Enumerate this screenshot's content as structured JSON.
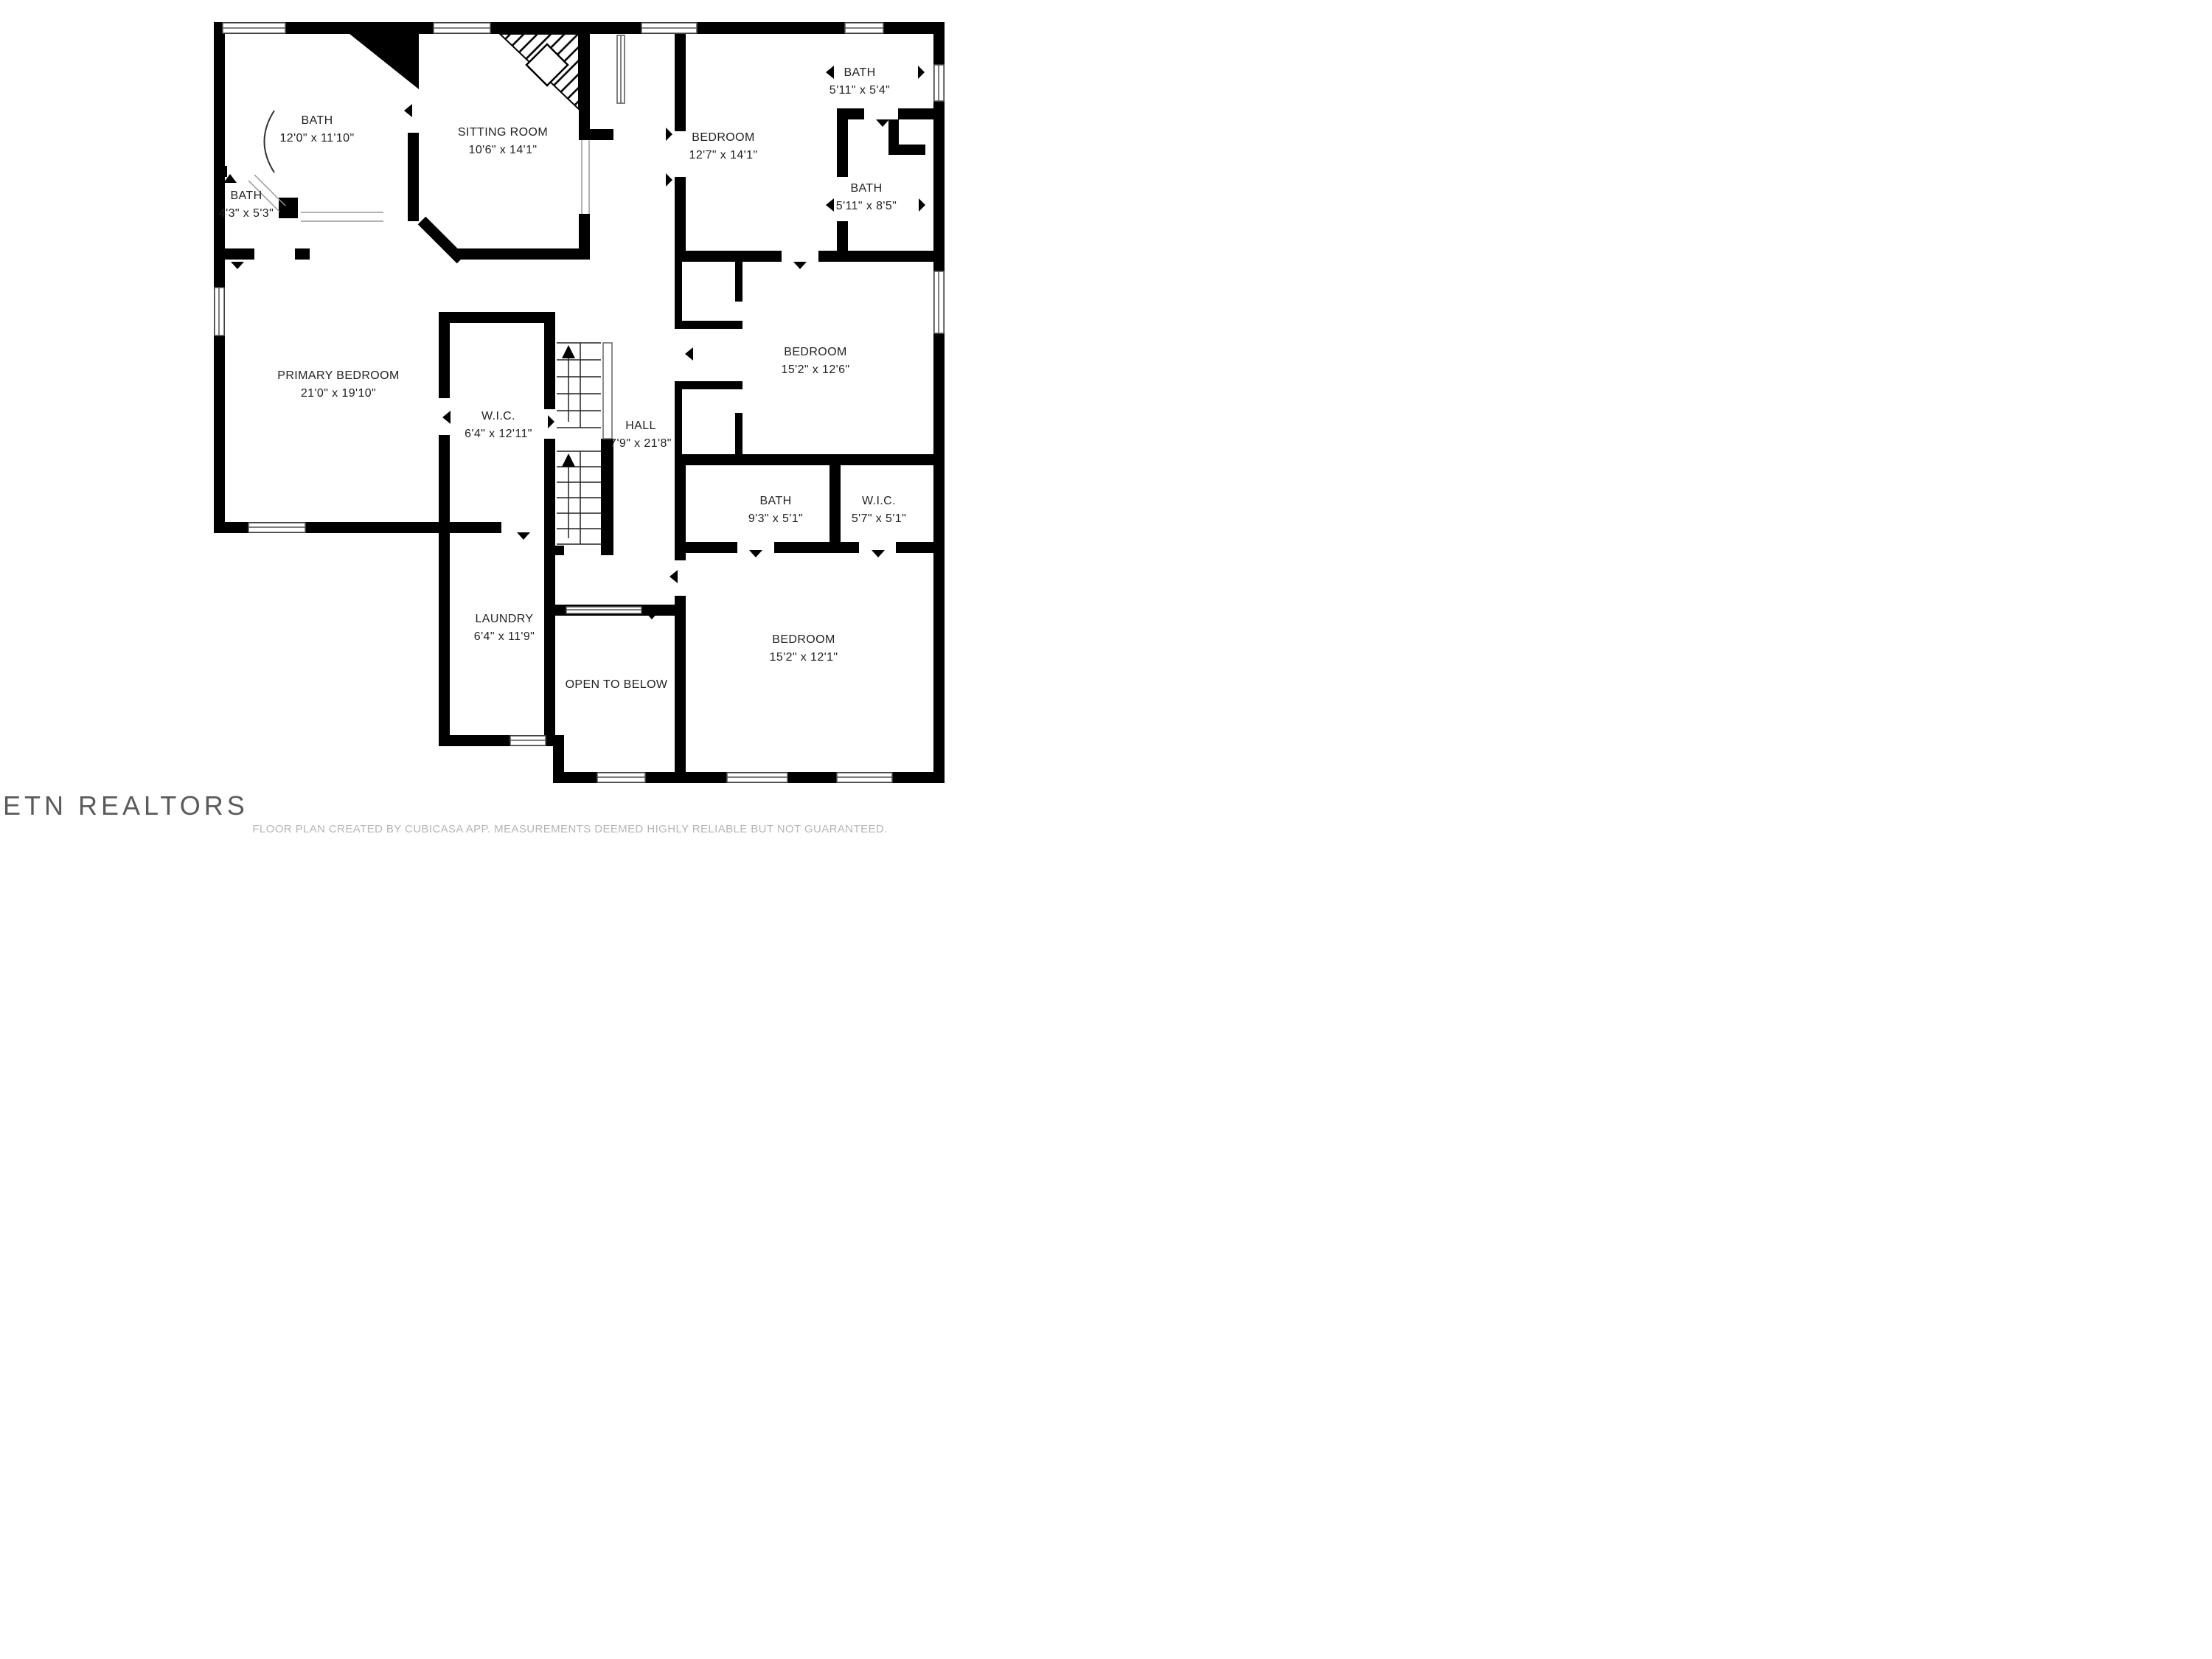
{
  "plan": {
    "rooms": {
      "bath_main": {
        "name": "BATH",
        "dims": "12'0\" x 11'10\""
      },
      "bath_small": {
        "name": "BATH",
        "dims": "4'3\" x 5'3\""
      },
      "sitting": {
        "name": "SITTING ROOM",
        "dims": "10'6\" x 14'1\""
      },
      "bedroom_top": {
        "name": "BEDROOM",
        "dims": "12'7\" x 14'1\""
      },
      "bath_topright": {
        "name": "BATH",
        "dims": "5'11\" x 5'4\""
      },
      "bath_right": {
        "name": "BATH",
        "dims": "5'11\" x 8'5\""
      },
      "primary": {
        "name": "PRIMARY BEDROOM",
        "dims": "21'0\" x 19'10\""
      },
      "wic_large": {
        "name": "W.I.C.",
        "dims": "6'4\" x 12'11\""
      },
      "hall": {
        "name": "HALL",
        "dims": "7'9\" x 21'8\""
      },
      "bedroom_mid": {
        "name": "BEDROOM",
        "dims": "15'2\" x 12'6\""
      },
      "bath_93": {
        "name": "BATH",
        "dims": "9'3\" x 5'1\""
      },
      "wic_small": {
        "name": "W.I.C.",
        "dims": "5'7\" x 5'1\""
      },
      "laundry": {
        "name": "LAUNDRY",
        "dims": "6'4\" x 11'9\""
      },
      "open_below": {
        "name": "OPEN TO BELOW",
        "dims": ""
      },
      "bedroom_bottom": {
        "name": "BEDROOM",
        "dims": "15'2\" x 12'1\""
      }
    },
    "watermark": "ETN REALTORS",
    "footer": "FLOOR PLAN CREATED BY CUBICASA APP. MEASUREMENTS DEEMED HIGHLY RELIABLE BUT NOT GUARANTEED.",
    "colors": {
      "wall": "#000000",
      "text": "#222222",
      "footer_text": "#b5b5b5",
      "watermark_text": "#3f3f3f"
    }
  }
}
